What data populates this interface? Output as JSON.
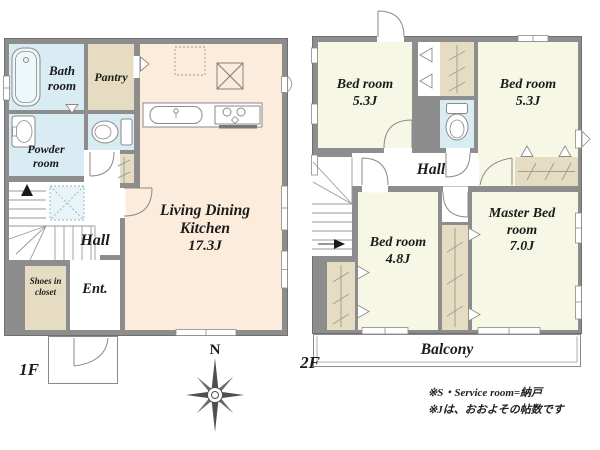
{
  "colors": {
    "wall": "#8d8d8d",
    "wet_area_fill": "#d9ecf3",
    "closet_fill": "#e6dcc2",
    "ldk_fill": "#fbecdc",
    "bedroom_fill": "#f7f7e6",
    "line": "#8a8a8a"
  },
  "floor1": {
    "label": "1F",
    "bath_room": "Bath room",
    "pantry": "Pantry",
    "powder_room": "Powder room",
    "hall": "Hall",
    "shoes_closet": "Shoes in closet",
    "entrance": "Ent.",
    "ldk_name": "Living Dining Kitchen",
    "ldk_area": "17.3J"
  },
  "floor2": {
    "label": "2F",
    "bedroom1_name": "Bed room",
    "bedroom1_area": "5.3J",
    "bedroom2_name": "Bed room",
    "bedroom2_area": "5.3J",
    "hall": "Hall",
    "bedroom3_name": "Bed room",
    "bedroom3_area": "4.8J",
    "master_name": "Master Bed room",
    "master_area": "7.0J",
    "balcony": "Balcony"
  },
  "compass": {
    "north": "N"
  },
  "footnotes": [
    "※S・Service room=納戸",
    "※Jは、おおよその帖数です"
  ]
}
